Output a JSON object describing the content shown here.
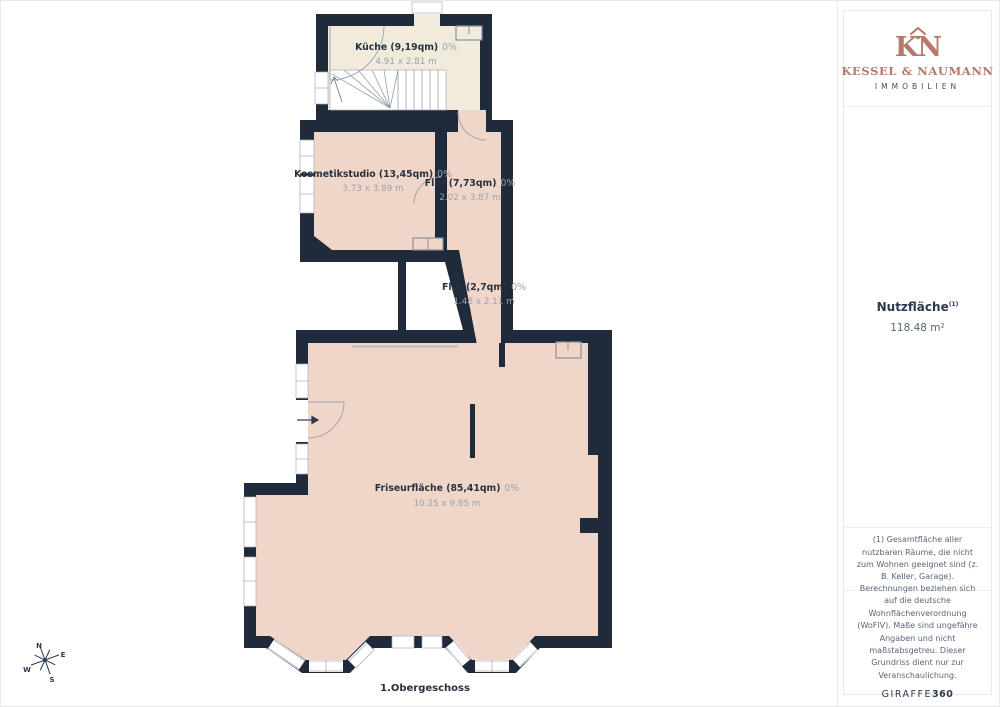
{
  "branding": {
    "monogram": "KN",
    "company": "KESSEL & NAUMANN",
    "division": "IMMOBILIEN",
    "logo_color": "#b5796d"
  },
  "sidebar": {
    "area_label": "Nutzfläche",
    "area_footnote_ref": "(1)",
    "area_value": "118.48 m²",
    "footnote": "(1) Gesamtfläche aller nutzbaren Räume, die nicht zum Wohnen geeignet sind (z. B. Keller, Garage).",
    "disclaimer": "Berechnungen beziehen sich auf die deutsche Wohnflächenverordnung (WoFlV). Maße sind ungefähre Angaben und nicht maßstabsgetreu. Dieser Grundriss dient nur zur Veranschaulichung.",
    "tool_brand": "GIRAFFE",
    "tool_brand_bold": "360"
  },
  "floorplan": {
    "floor_label": "1.Obergeschoss",
    "compass": {
      "north": "N",
      "east": "E",
      "south": "S",
      "west": "W"
    },
    "rooms": [
      {
        "title": "Küche (9,19qm)",
        "percent": "0%",
        "dims": "4.91 x 2.81 m"
      },
      {
        "title": "Kosmetikstudio (13,45qm)",
        "percent": "0%",
        "dims": "3.73 x 3.89 m"
      },
      {
        "title": "Flur (7,73qm)",
        "percent": "0%",
        "dims": "2.02 x 3.87 m"
      },
      {
        "title": "Flur (2,7qm)",
        "percent": "0%",
        "dims": "1.48 x 2.11 m"
      },
      {
        "title": "Friseurfläche (85,41qm)",
        "percent": "0%",
        "dims": "10.25 x 9.85 m"
      }
    ],
    "colors": {
      "wall": "#1f2a3a",
      "room_cream": "#f1ebdb",
      "room_pink": "#f0d6c8"
    }
  }
}
